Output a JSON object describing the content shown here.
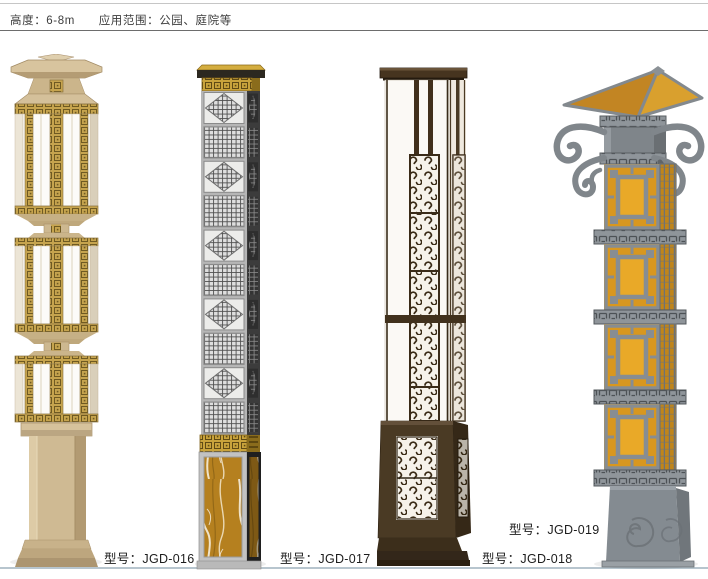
{
  "header": {
    "height_label": "高度：6-8m",
    "application_label": "应用范围：公园、庭院等"
  },
  "products": [
    {
      "id": "jgd-016",
      "label_prefix": "型号：",
      "model": "JGD-016"
    },
    {
      "id": "jgd-017",
      "label_prefix": "型号：",
      "model": "JGD-017"
    },
    {
      "id": "jgd-018",
      "label_prefix": "型号：",
      "model": "JGD-018"
    },
    {
      "id": "jgd-019",
      "label_prefix": "型号：",
      "model": "JGD-019"
    }
  ],
  "colors": {
    "top_line": "#c6c6c6",
    "header_rule": "#6d6d6d",
    "ground_line": "#b7c5ce",
    "text": "#1c1c1c",
    "lamp1_beige": "#d3bf9a",
    "lamp1_gold": "#c2a24c",
    "lamp1_panel": "#fcfbf8",
    "lamp2_silver": "#b4b4b4",
    "lamp2_gold_band": "#c9a33c",
    "lamp2_marble": "#b5801f",
    "lamp2_dark_side": "#383838",
    "lamp3_bronze": "#44331f",
    "lamp3_panel": "#fbf9f5",
    "lamp4_gray": "#858b90",
    "lamp4_amber": "#d8971f"
  }
}
